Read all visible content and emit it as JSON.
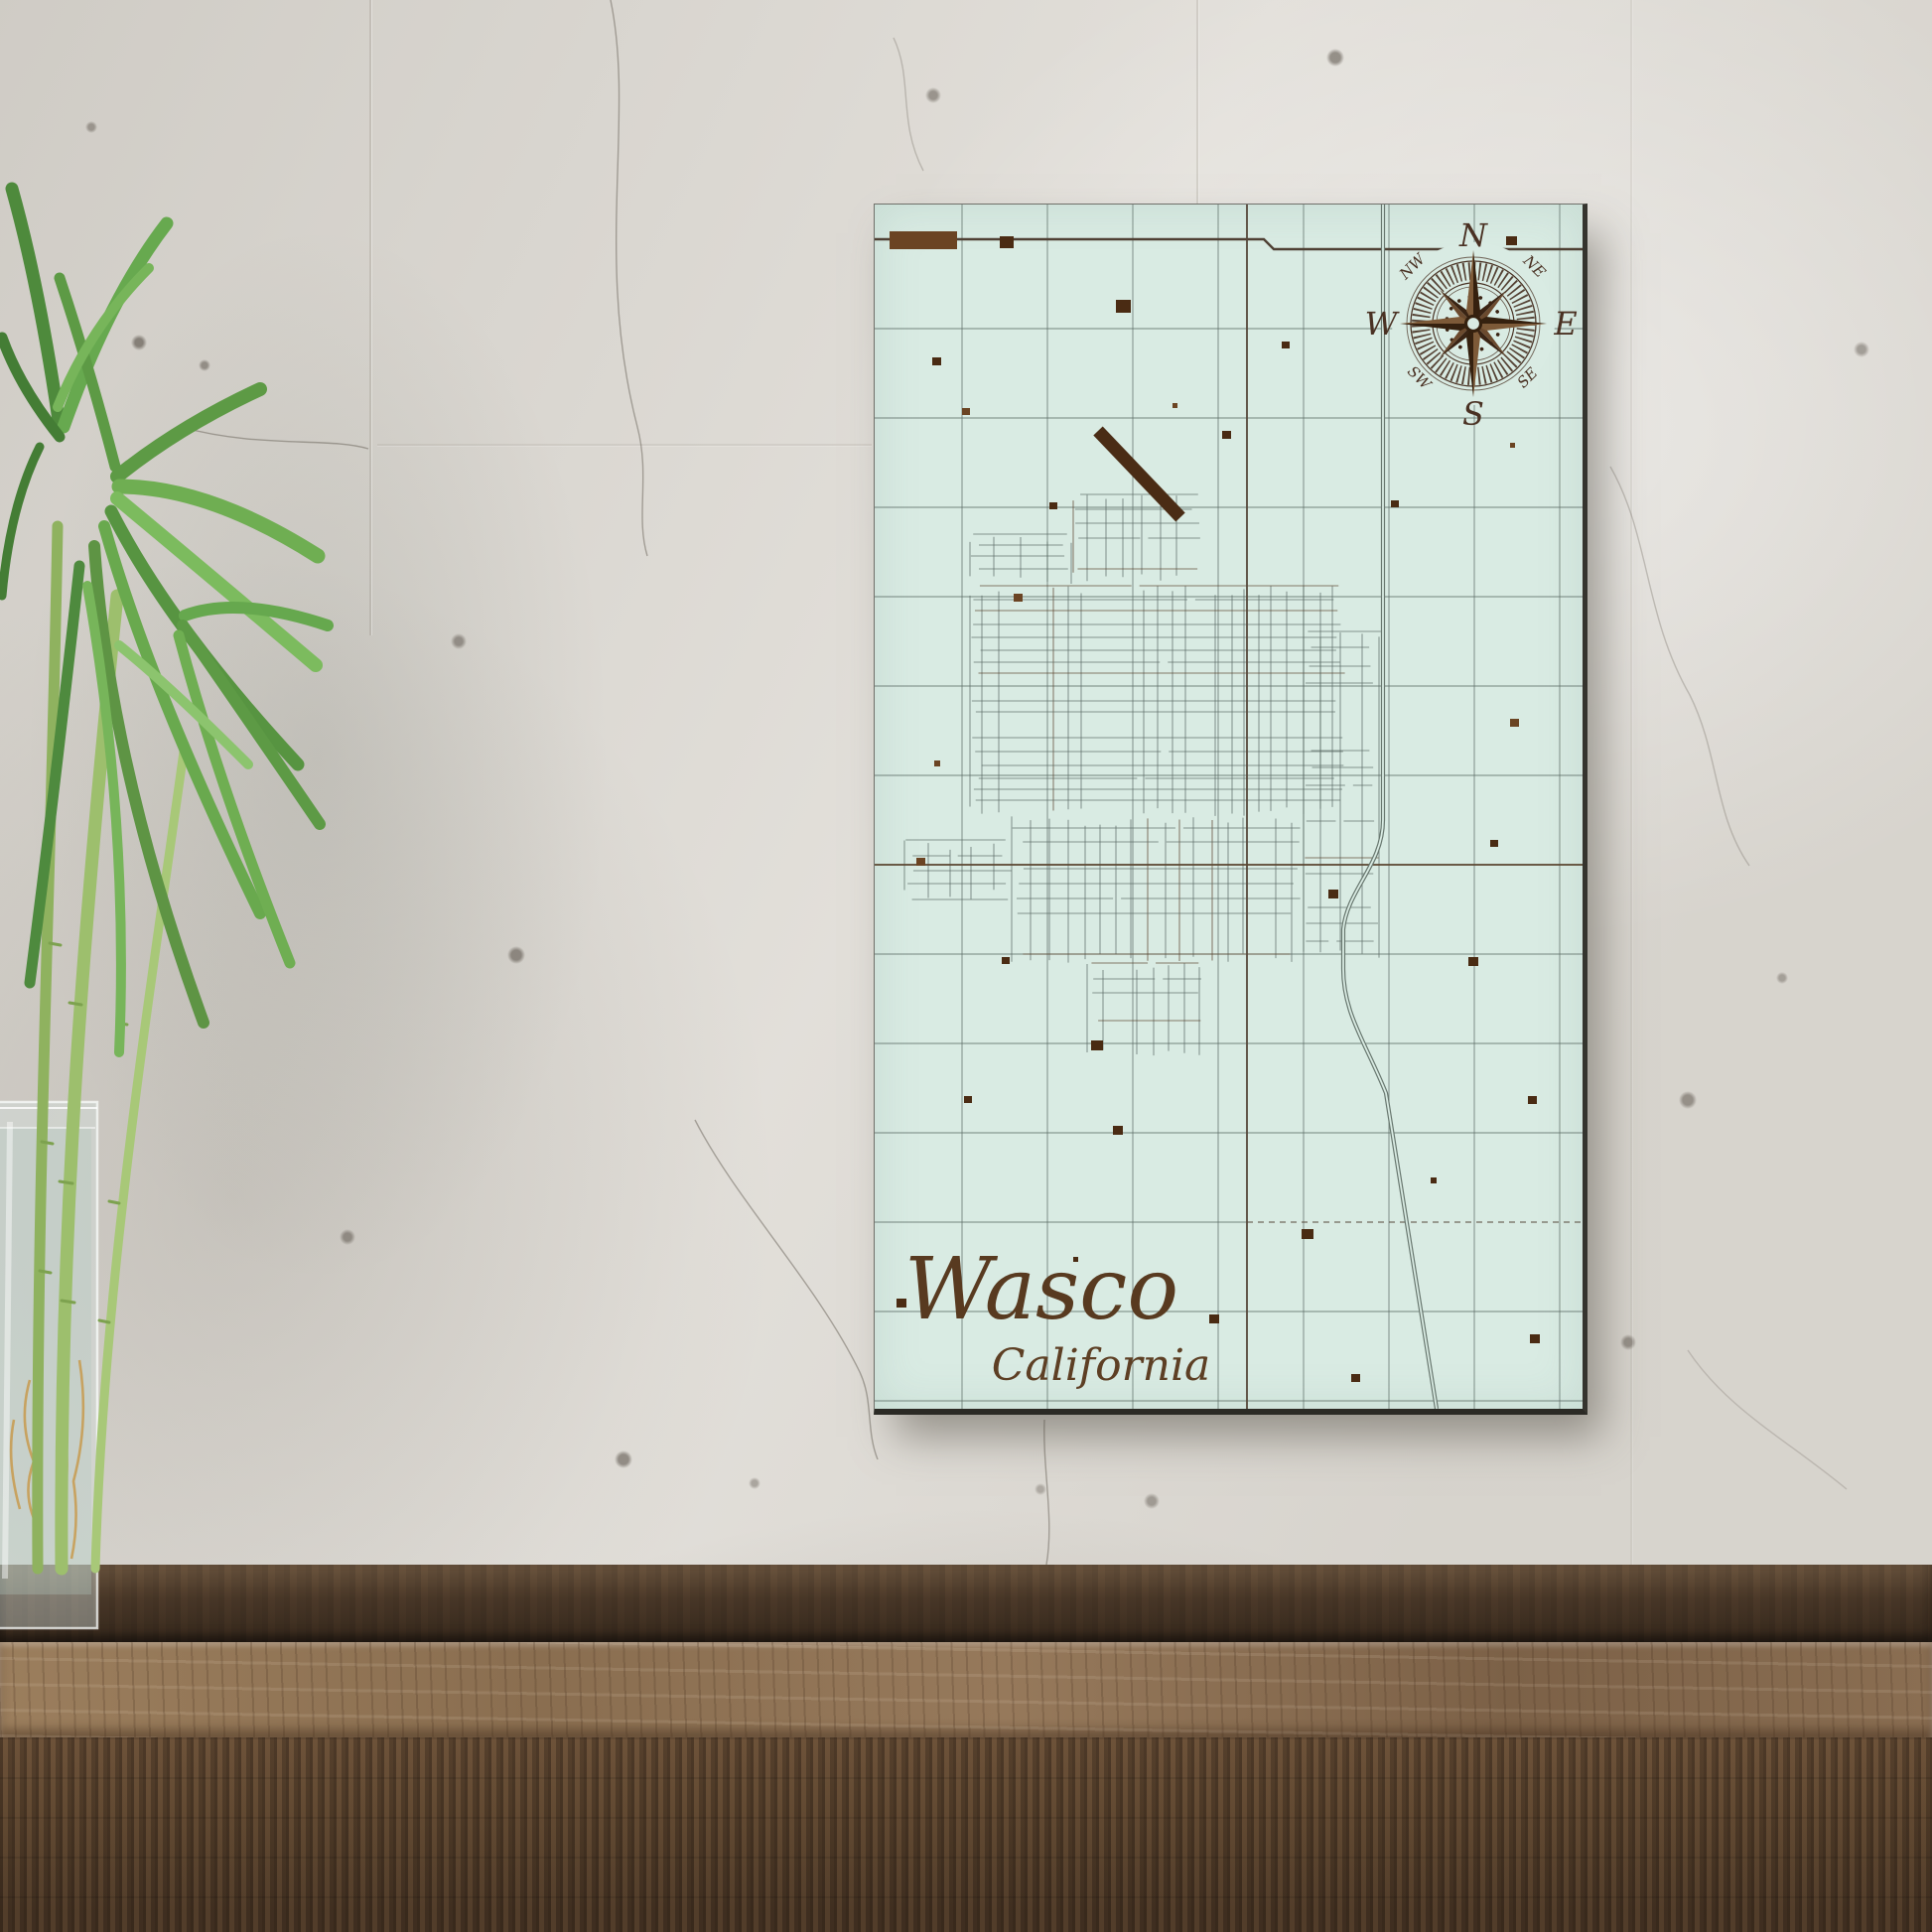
{
  "map": {
    "title": "Wasco",
    "subtitle": "California",
    "compass": {
      "north": "N",
      "east": "E",
      "south": "S",
      "west": "W",
      "northwest": "NW",
      "northeast": "NE",
      "southwest": "SW",
      "southeast": "SE"
    }
  },
  "colors": {
    "map_background": "#d9ebe3",
    "engraving_brown": "#4a2d15",
    "street_line": "#5a6a64",
    "wall_concrete": "#d8d5cf",
    "bench_wood": "#5c452f",
    "leaf_green": "#66a84e",
    "stem_green": "#9dbf6d"
  }
}
